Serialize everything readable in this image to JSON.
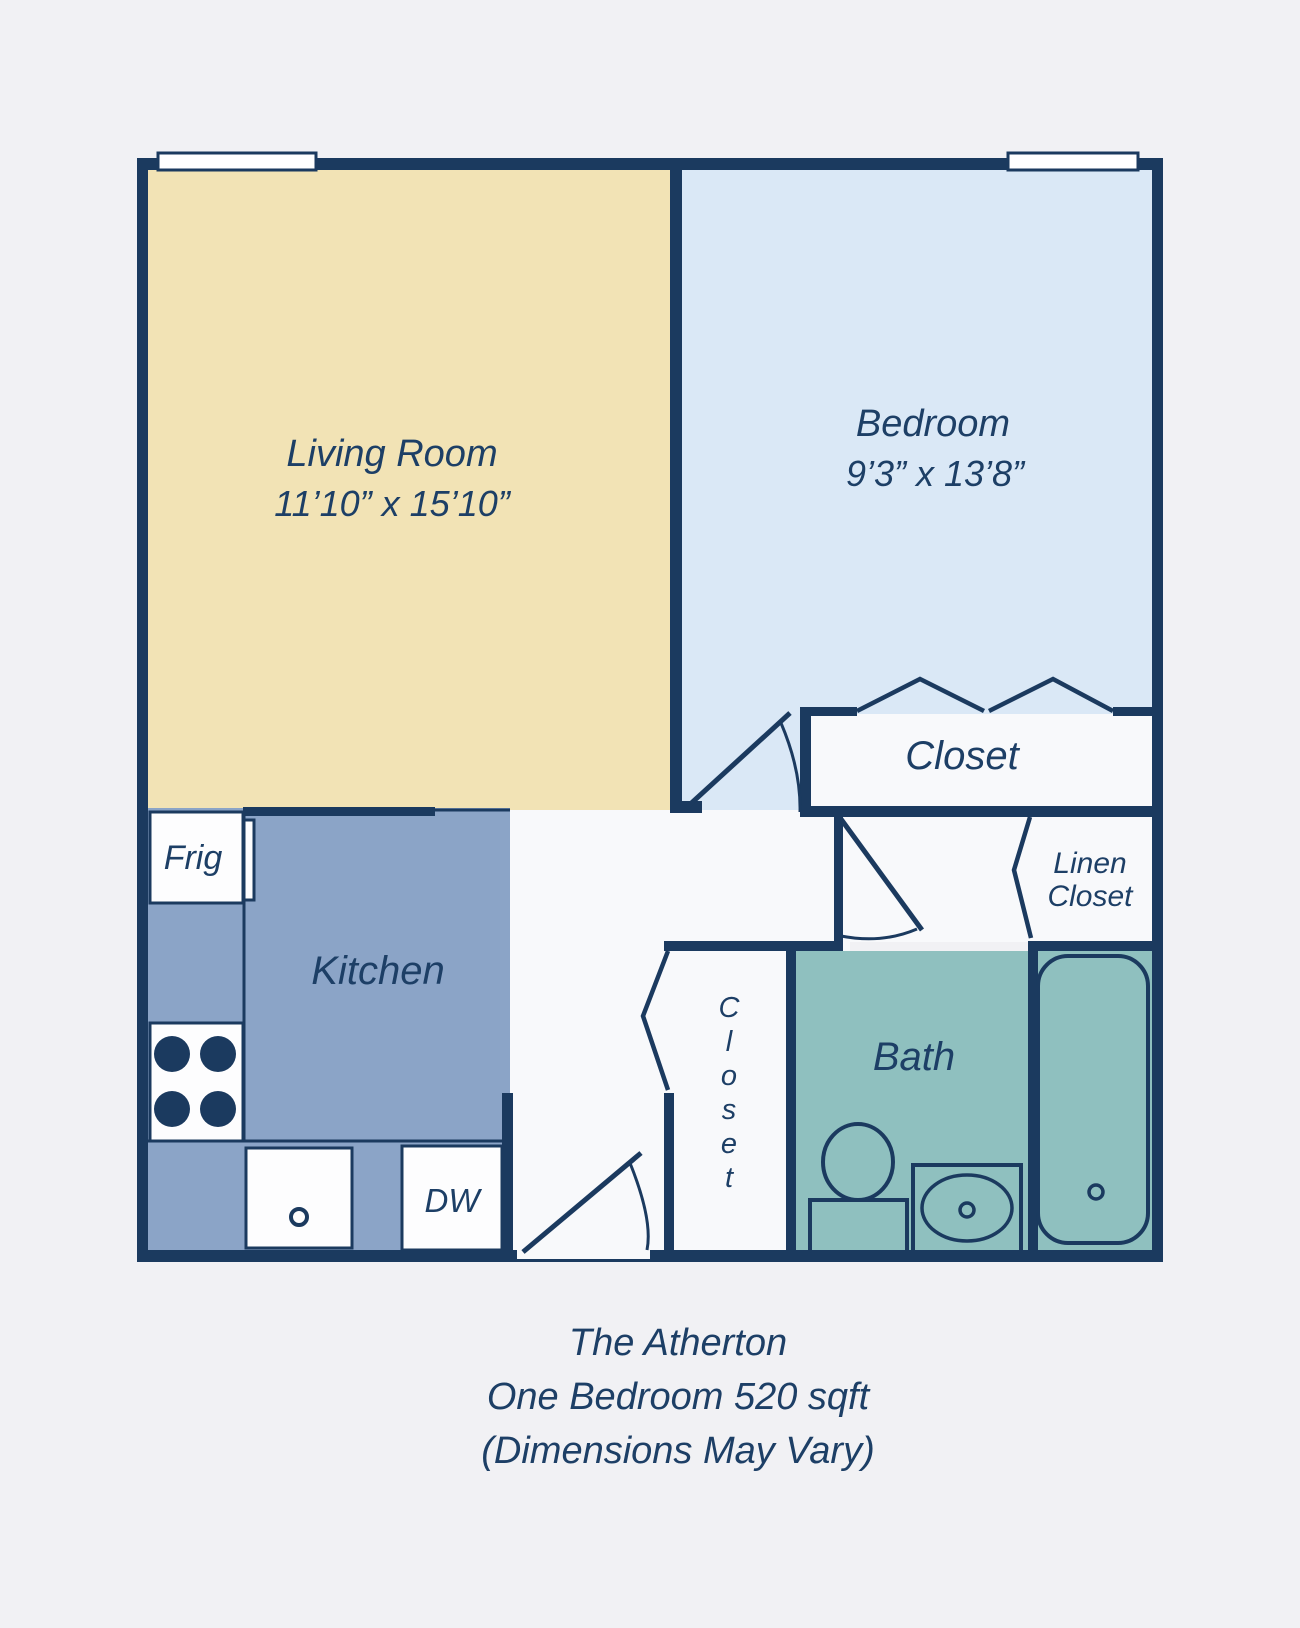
{
  "rooms": {
    "living_room": {
      "name": "Living Room",
      "dimensions": "11’10” x 15’10”"
    },
    "bedroom": {
      "name": "Bedroom",
      "dimensions": "9’3” x 13’8”"
    },
    "bedroom_closet": {
      "label": "Closet"
    },
    "linen_closet": {
      "line1": "Linen",
      "line2": "Closet"
    },
    "hall_closet": {
      "name": "Closet",
      "letters": [
        "C",
        "l",
        "o",
        "s",
        "e",
        "t"
      ]
    },
    "kitchen": {
      "label": "Kitchen"
    },
    "bath": {
      "label": "Bath"
    }
  },
  "appliances": {
    "fridge": "Frig",
    "dishwasher": "DW"
  },
  "caption": {
    "line1": "The Atherton",
    "line2": "One Bedroom 520 sqft",
    "line3": "(Dimensions May Vary)"
  },
  "colors": {
    "wall_navy": "#1b3a5f",
    "text_navy": "#1d3f66",
    "living_room": "#f2e3b5",
    "bedroom": "#dae8f6",
    "kitchen": "#8ba4c7",
    "bath": "#8fc0bf",
    "interior_white": "#f8f9fb",
    "background": "#f1f1f4"
  }
}
